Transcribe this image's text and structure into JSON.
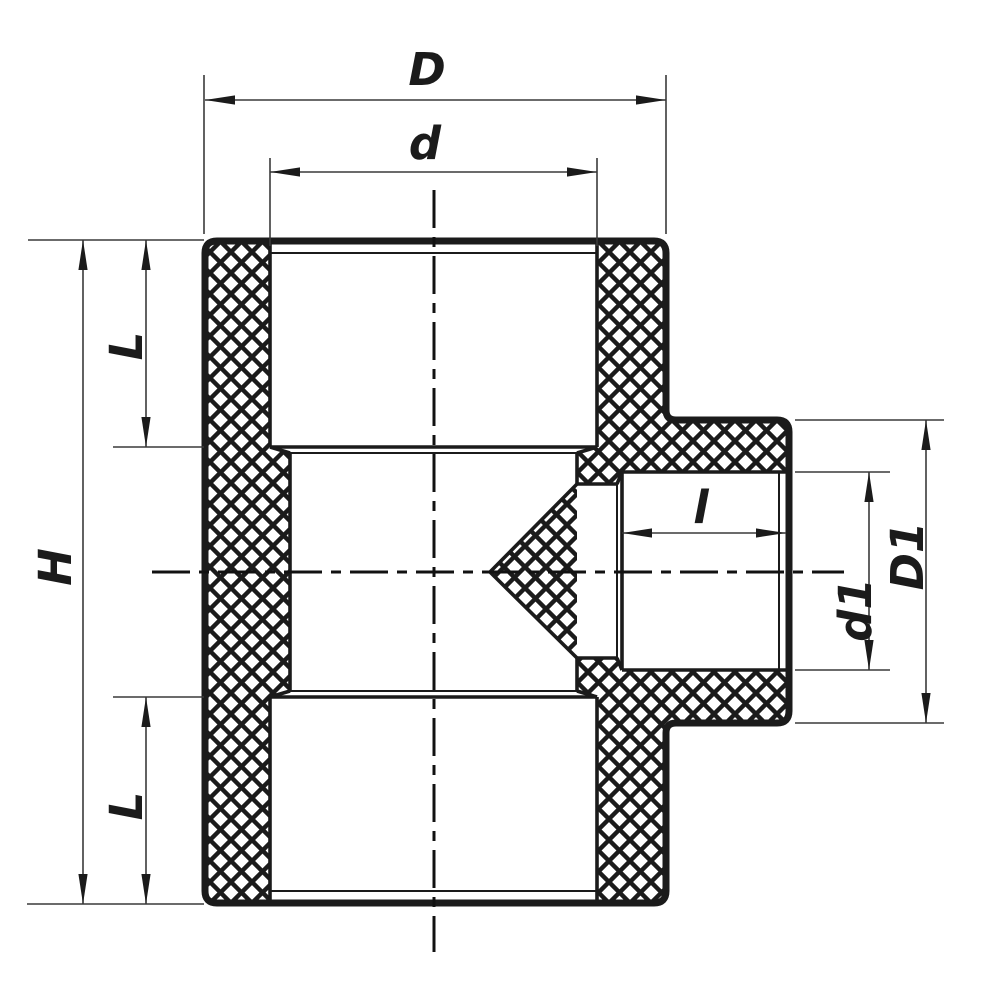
{
  "drawing": {
    "type": "technical-section-drawing",
    "subject": "pipe tee fitting cross-section with crosshatched walls",
    "background": "#ffffff",
    "line_color": "#1b1b1b",
    "dim_line_color": "#3a3a3a",
    "labels": {
      "D": "D",
      "d": "d",
      "H": "H",
      "L_top": "L",
      "L_bottom": "L",
      "l": "l",
      "d1": "d1",
      "D1": "D1"
    },
    "dimensions": [
      {
        "label": "D",
        "orientation": "horizontal",
        "position": "top outer"
      },
      {
        "label": "d",
        "orientation": "horizontal",
        "position": "top inner"
      },
      {
        "label": "H",
        "orientation": "vertical",
        "position": "left outer"
      },
      {
        "label": "L",
        "orientation": "vertical",
        "position": "left upper"
      },
      {
        "label": "L",
        "orientation": "vertical",
        "position": "left lower"
      },
      {
        "label": "l",
        "orientation": "horizontal",
        "position": "branch socket"
      },
      {
        "label": "d1",
        "orientation": "vertical",
        "position": "branch inner"
      },
      {
        "label": "D1",
        "orientation": "vertical",
        "position": "branch outer"
      }
    ]
  }
}
